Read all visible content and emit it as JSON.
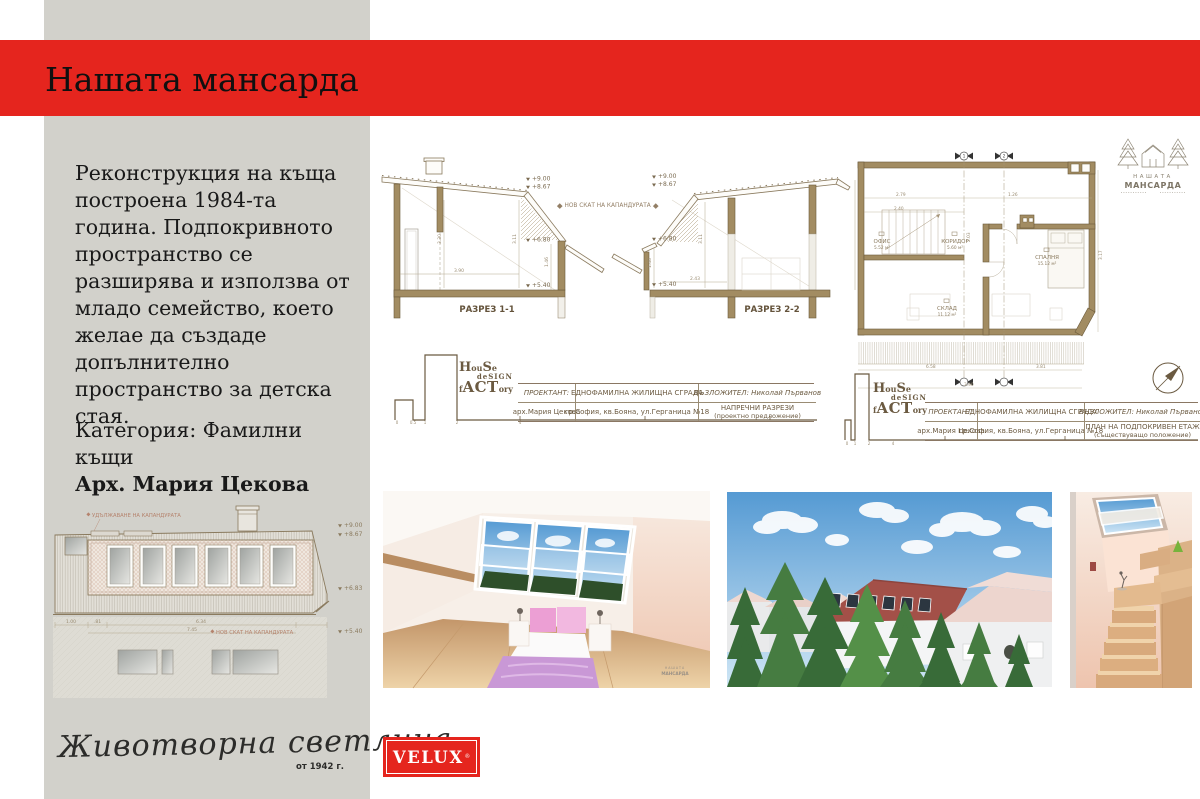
{
  "colors": {
    "velux_red": "#e5251e",
    "sidebar_gray": "#d2d1cb",
    "wall_tan": "#a28c62",
    "line_brown": "#8a7a5e",
    "annotation_salmon": "#b5836d"
  },
  "header": {
    "title": "Нашата мансарда"
  },
  "sidebar": {
    "description": "Реконструкция на къща построена 1984-та година. Подпокривното пространство се разширява и използва от младо семейство, което желае да създаде допълнително пространство за детска стая.",
    "category": "Категория: Фамилни къщи",
    "architect": "Арх. Мария Цекова",
    "tagline": "Животворна светлина",
    "tagline_since": "от 1942 г."
  },
  "brand": {
    "velux": "VELUX",
    "velux_reg": "®",
    "mansarda": {
      "line1": "НАШАТА",
      "line2": "МАНСАРДА"
    },
    "hd": {
      "h": "H",
      "ou": "ou",
      "s": "S",
      "e": "e",
      "de": "de",
      "sign": "SIGN",
      "f": "f",
      "act": "ACT",
      "ory": "ory"
    }
  },
  "sections": {
    "annotation": "НОВ СКАТ НА КАПАНДУРАТА",
    "s1": {
      "label": "РАЗРЕЗ 1-1",
      "levels": [
        "+9.00",
        "+8.67",
        "+6.80",
        "+5.40"
      ],
      "dims": [
        "3.30",
        "3.11",
        "3.90",
        "1.46"
      ]
    },
    "s2": {
      "label": "РАЗРЕЗ 2-2",
      "levels": [
        "+9.00",
        "+8.67",
        "+6.80",
        "+5.40"
      ],
      "dims": [
        "1.48",
        "2.43",
        "3.11"
      ]
    }
  },
  "plan": {
    "rooms": [
      {
        "name": "ОФИС",
        "area": "5.52 м²"
      },
      {
        "name": "КОРИДОР",
        "area": "5.60 м²"
      },
      {
        "name": "СПАЛНЯ",
        "area": "15.12 м²"
      },
      {
        "name": "СКЛАД",
        "area": "11.12 м²"
      }
    ],
    "markers": [
      "1",
      "2"
    ],
    "dims": [
      "2.79",
      "2.40",
      "1.26",
      "2.03",
      "6.58",
      "3.81",
      "3.90",
      "3.17"
    ]
  },
  "elevation": {
    "annotation_top": "УДЪЛЖАВАНЕ НА КАПАНДУРАТА",
    "annotation_mid": "НОВ СКАТ НА КАПАНДУРАТА",
    "levels": [
      "+9.00",
      "+8.67",
      "+6.83",
      "+5.40"
    ],
    "dims": [
      "1.00",
      ".81",
      "6.34",
      "7.45"
    ]
  },
  "tb1": {
    "designer_label": "ПРОЕКТАНТ:",
    "designer_name": "арх.Мария Цекова",
    "project_name": "ЕДНОФАМИЛНА ЖИЛИЩНА СГРАДА",
    "project_address": "гр.София, кв.Бояна, ул.Герганица №18",
    "client": "ВЪЗЛОЖИТЕЛ: Николай Първанов",
    "drawing_name": "НАПРЕЧНИ РАЗРЕЗИ",
    "drawing_phase": "(проектно предложение)"
  },
  "tb2": {
    "designer_label": "ПРОЕКТАНТ:",
    "designer_name": "арх.Мария Цекова",
    "project_name": "ЕДНОФАМИЛНА ЖИЛИЩНА СГРАДА",
    "project_address": "гр.София, кв.Бояна, ул.Герганица №18",
    "client": "ВЪЗЛОЖИТЕЛ: Николай Първанов",
    "drawing_name": "ПЛАН НА ПОДПОКРИВЕН ЕТАЖ",
    "drawing_phase": "(съществуващо положение)"
  },
  "scale": {
    "ticks": [
      "0",
      "0.5",
      "1",
      "2",
      "4"
    ]
  }
}
